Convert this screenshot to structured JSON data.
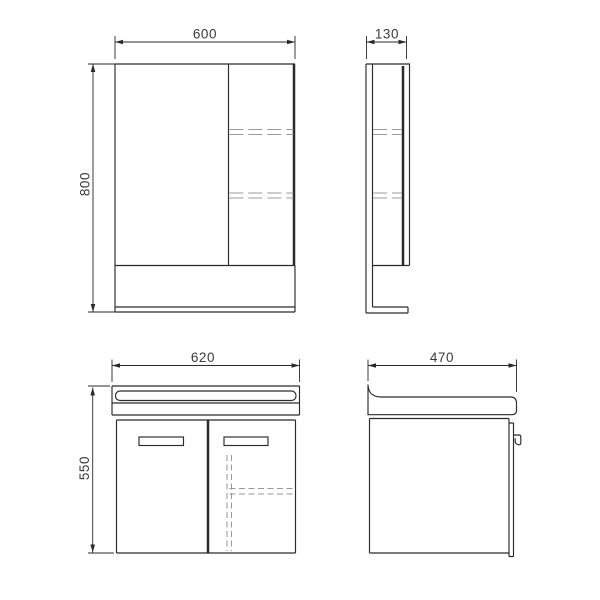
{
  "page": {
    "background": "#ffffff",
    "description": "Technical dimension drawing: bathroom mirror cabinet and washbasin vanity unit, four orthographic views"
  },
  "drawing": {
    "line_color": "#2a2a2a",
    "hidden_line_color": "#9b9b9b",
    "text_color": "#3a3a3a",
    "views": {
      "mirror_front": {
        "title": "mirror-cabinet-front-view",
        "width_label": "600",
        "height_label": "800"
      },
      "mirror_side": {
        "title": "mirror-cabinet-side-view",
        "depth_label": "130"
      },
      "vanity_front": {
        "title": "vanity-front-view",
        "width_label": "620",
        "height_label": "550"
      },
      "vanity_side": {
        "title": "vanity-side-view",
        "depth_label": "470"
      }
    }
  }
}
